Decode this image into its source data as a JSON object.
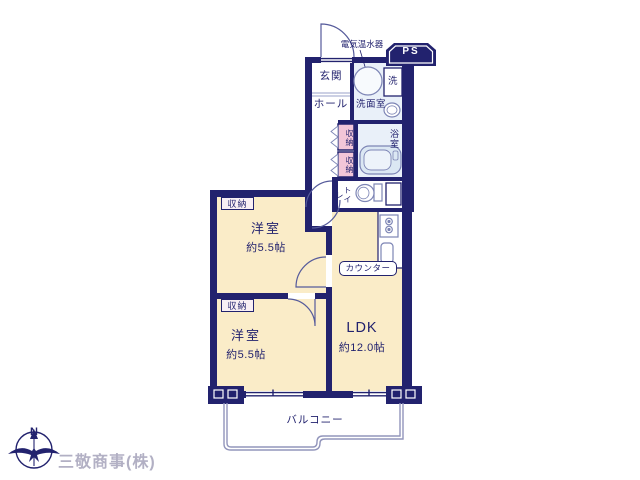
{
  "plan": {
    "labels": {
      "entrance": "玄関",
      "hall": "ホール",
      "washroom": "洗面室",
      "washer": "洗",
      "closet": "収納",
      "bathroom": "浴室",
      "toilet": "トイレ",
      "counter": "カウンター",
      "balcony": "バルコニー",
      "ps": "PS",
      "water_heater": "電気温水器"
    },
    "rooms": {
      "bedroom1": {
        "name": "洋室",
        "area": "約5.5帖"
      },
      "bedroom2": {
        "name": "洋室",
        "area": "約5.5帖"
      },
      "ldk": {
        "name": "LDK",
        "area": "約12.0帖"
      }
    },
    "compass": {
      "north": "N"
    },
    "watermark": "三敬商事(株)",
    "colors": {
      "wall": "#22226e",
      "room_floor": "#faecc8",
      "wet_floor": "#e9f0f9",
      "closet_pink": "#f2c6d8",
      "closet_label_bg": "#f8eff4",
      "fixture_line": "#7d85b5",
      "balcony_line": "#9295bb",
      "watermark_gray": "#b2b0c4"
    }
  }
}
